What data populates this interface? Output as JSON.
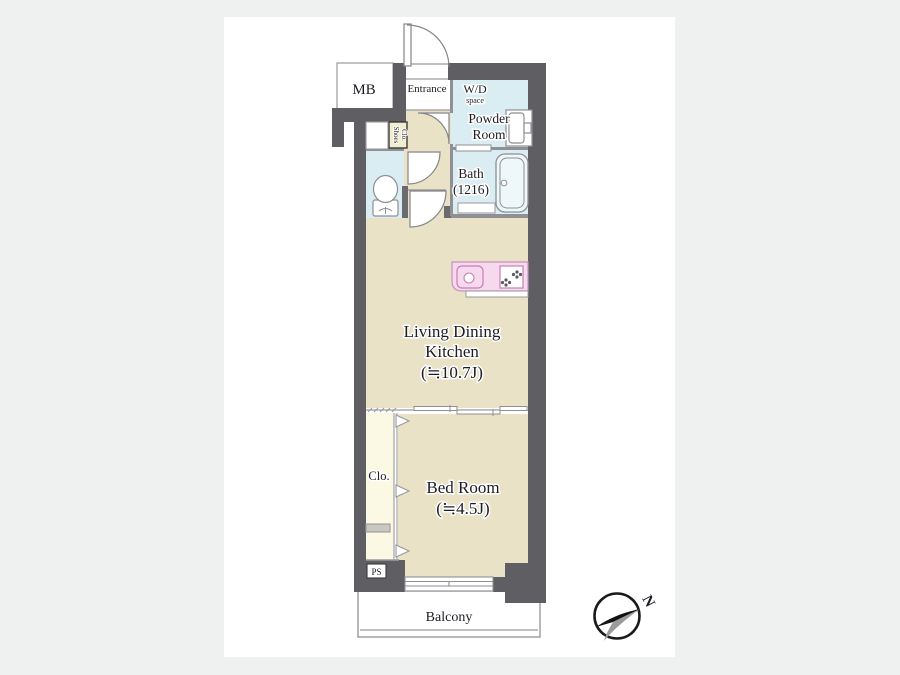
{
  "plan": {
    "mb": {
      "label": "MB"
    },
    "entrance": {
      "label": "Entrance"
    },
    "wd": {
      "line1": "W/D",
      "line2": "space"
    },
    "powder": {
      "line1": "Powder",
      "line2": "Room"
    },
    "bath": {
      "line1": "Bath",
      "line2": "(1216)"
    },
    "shoes": {
      "line1": "Shoes",
      "line2": "Clo."
    },
    "ldk": {
      "line1": "Living Dining",
      "line2": "Kitchen",
      "line3": "(≒10.7J)"
    },
    "closet": {
      "label": "Clo."
    },
    "bedroom": {
      "line1": "Bed Room",
      "line2": "(≒4.5J)"
    },
    "ps": {
      "label": "PS"
    },
    "balcony": {
      "label": "Balcony"
    },
    "compass": {
      "north": "N"
    }
  },
  "rooms": [
    {
      "name": "Living Dining Kitchen",
      "size": "≒10.7J"
    },
    {
      "name": "Bed Room",
      "size": "≒4.5J"
    },
    {
      "name": "Bath",
      "size": "1216"
    }
  ],
  "colors": {
    "wall": "#5f5f63",
    "floor": "#e9e2c6",
    "wet": "#d9edf3",
    "closet": "#fbf8e3",
    "shoes_box": "#f2edcf",
    "kitchen": "#f6d9ec",
    "kitchen_line": "#c892c2",
    "thin_line": "#8f8f94",
    "background": "#eff0f0",
    "compass_gray": "#9b9b9b"
  }
}
